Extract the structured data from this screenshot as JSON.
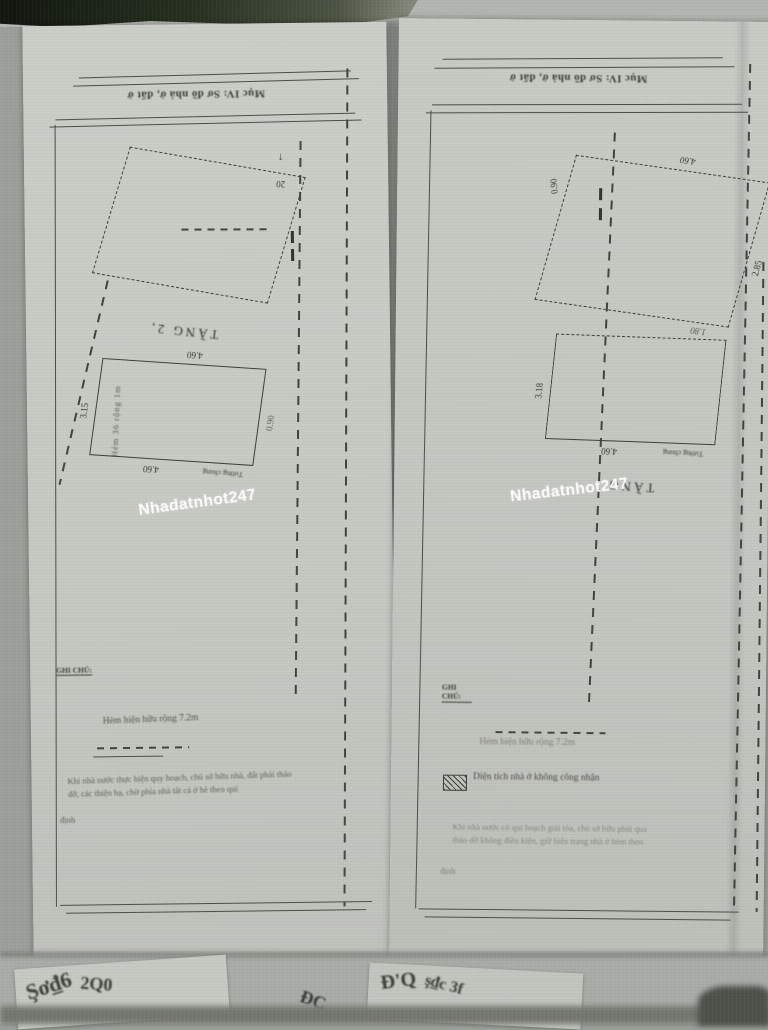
{
  "photo": {
    "watermark": "Nhadatnhot247"
  },
  "left": {
    "header": "Mục IV: Sơ đồ nhà ở, đất ở",
    "north_arrow": "↑",
    "boundary_dim": "20",
    "floor_label": "TẦNG 2,",
    "wall_label": "Tường chung",
    "dim_top": "4.60",
    "dim_bottom": "4.60",
    "dim_side": "3.15",
    "dim_side2": "0.90",
    "side_annotation": "Hẻm 36 rộng 1m",
    "notes_title": "GHI CHÚ:",
    "notes_line1": "Hẻm hiện hữu rộng 7.2m",
    "notes_para1": "Khi nhà nước thực hiện quy hoạch, chủ sở hữu nhà, đất phải tháo",
    "notes_para2": "dỡ, các thiện hạ, chờ phía nhà tất cả ở hè theo qui",
    "notes_para3": "định"
  },
  "right": {
    "header": "Mục IV: Sơ đồ nhà ở, đất ở",
    "floor_label": "TẦNG",
    "wall_label": "Tường chung",
    "dim_mid": "4.60",
    "dim_side": "3.18",
    "dim_bottom": "4.60",
    "dim_right": "0.90",
    "dim_left": "2.85",
    "dim_top": "1.80",
    "notes_title": "GHI CHÚ:",
    "notes_line1": "Hẻm hiện hữu rộng 7.2m",
    "legend": "Diện tích nhà ở không công nhận",
    "notes_para1": "Khi nhà nước có qui hoạch giải tỏa, chủ sở hữu phải qua",
    "notes_para2": "tháo dỡ không điều kiện, giữ hiện trạng nhà ở hẻm theo",
    "notes_para3": "định"
  },
  "debris": {
    "g1": "Şơ₫6",
    "g2": "2Q0",
    "g3": "Đ'Q",
    "g4": "ş₫c 3f",
    "g5": "ĐC"
  }
}
